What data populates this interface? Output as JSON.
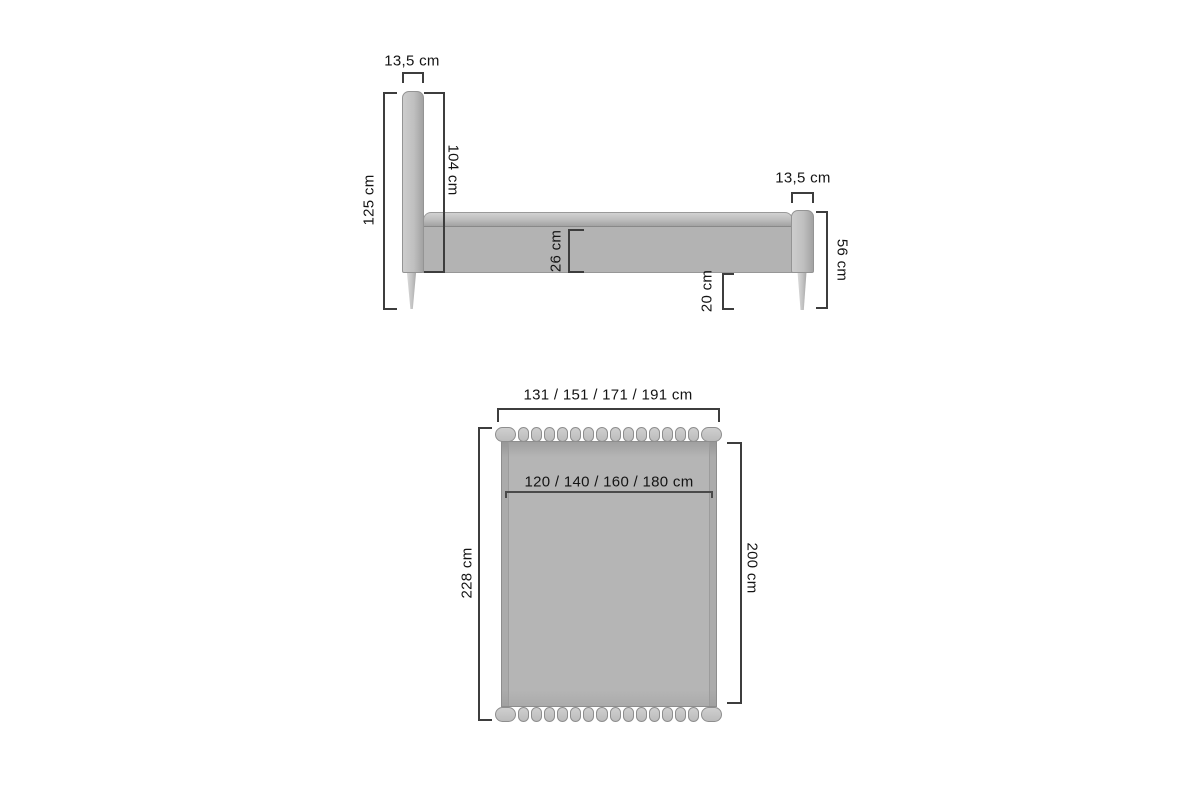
{
  "page": {
    "background": "#ffffff"
  },
  "colors": {
    "upholstery_fill": "#b5b5b5",
    "upholstery_light": "#cdcdcd",
    "tufting_pill_fill": "#c8c8c8",
    "outline": "#8f8f8f",
    "dimension_line": "#3d3d3d",
    "label_text": "#141414"
  },
  "side_view": {
    "headboard_width_label": "13,5 cm",
    "total_height_label": "125 cm",
    "headboard_above_base_label": "104 cm",
    "side_rail_height_label": "26 cm",
    "footboard_depth_label": "13,5 cm",
    "footboard_height_label": "56 cm",
    "floor_clearance_label": "20 cm"
  },
  "top_view": {
    "overall_width_label": "131 / 151 / 171 / 191 cm",
    "mattress_width_label": "120 / 140 / 160 / 180  cm",
    "overall_length_label": "228 cm",
    "mattress_length_label": "200 cm"
  }
}
